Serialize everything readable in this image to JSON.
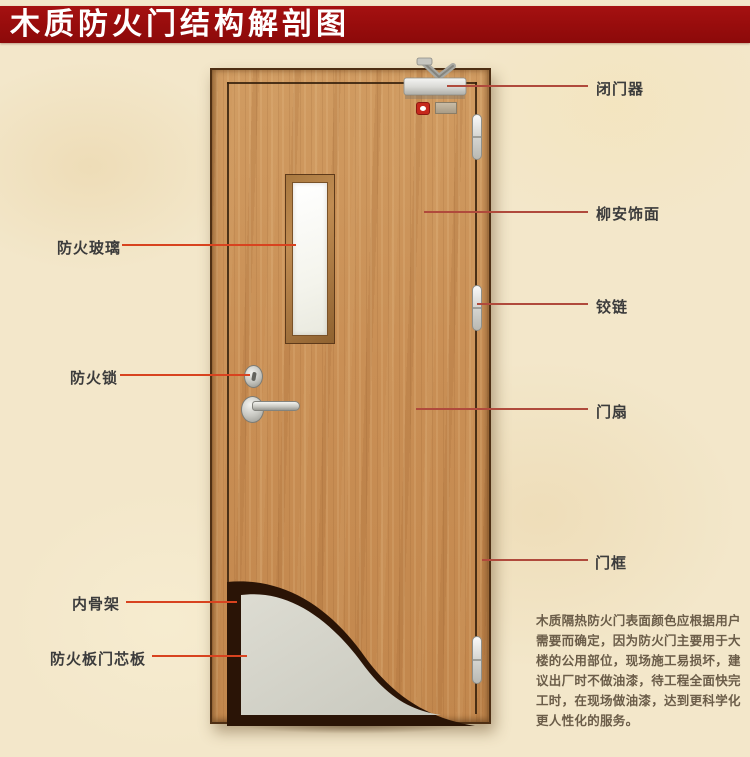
{
  "page": {
    "title_banner": "木质防火门结构解剖图"
  },
  "annotations": {
    "left": [
      {
        "label": "防火玻璃"
      },
      {
        "label": "防火锁"
      },
      {
        "label": "内骨架"
      },
      {
        "label": "防火板门芯板"
      }
    ],
    "right": [
      {
        "label": "闭门器"
      },
      {
        "label": "柳安饰面"
      },
      {
        "label": "铰链"
      },
      {
        "label": "门扇"
      },
      {
        "label": "门框"
      }
    ]
  },
  "description": {
    "lines": [
      "木质隔热防火门表面颜色应根据用户",
      "需要而确定，因为防火门主要用于大",
      "楼的公用部位，现场施工易损坏，建",
      "议出厂时不做油漆，待工程全面快完",
      "工时，在现场做油漆，达到更科学化",
      "更人性化的服务。"
    ]
  },
  "colors": {
    "banner_bg": "#9b0e0e",
    "banner_text": "#ffffff",
    "label_text": "#3c3c3c",
    "leader_left": "#d8431f",
    "leader_right": "#b04a3c",
    "door_wood": "#c98f55",
    "glass": "#f7f7ef",
    "core_board": "#d2d2c8",
    "inner_frame_dark": "#2a1406",
    "description_text": "#6b5d49"
  }
}
